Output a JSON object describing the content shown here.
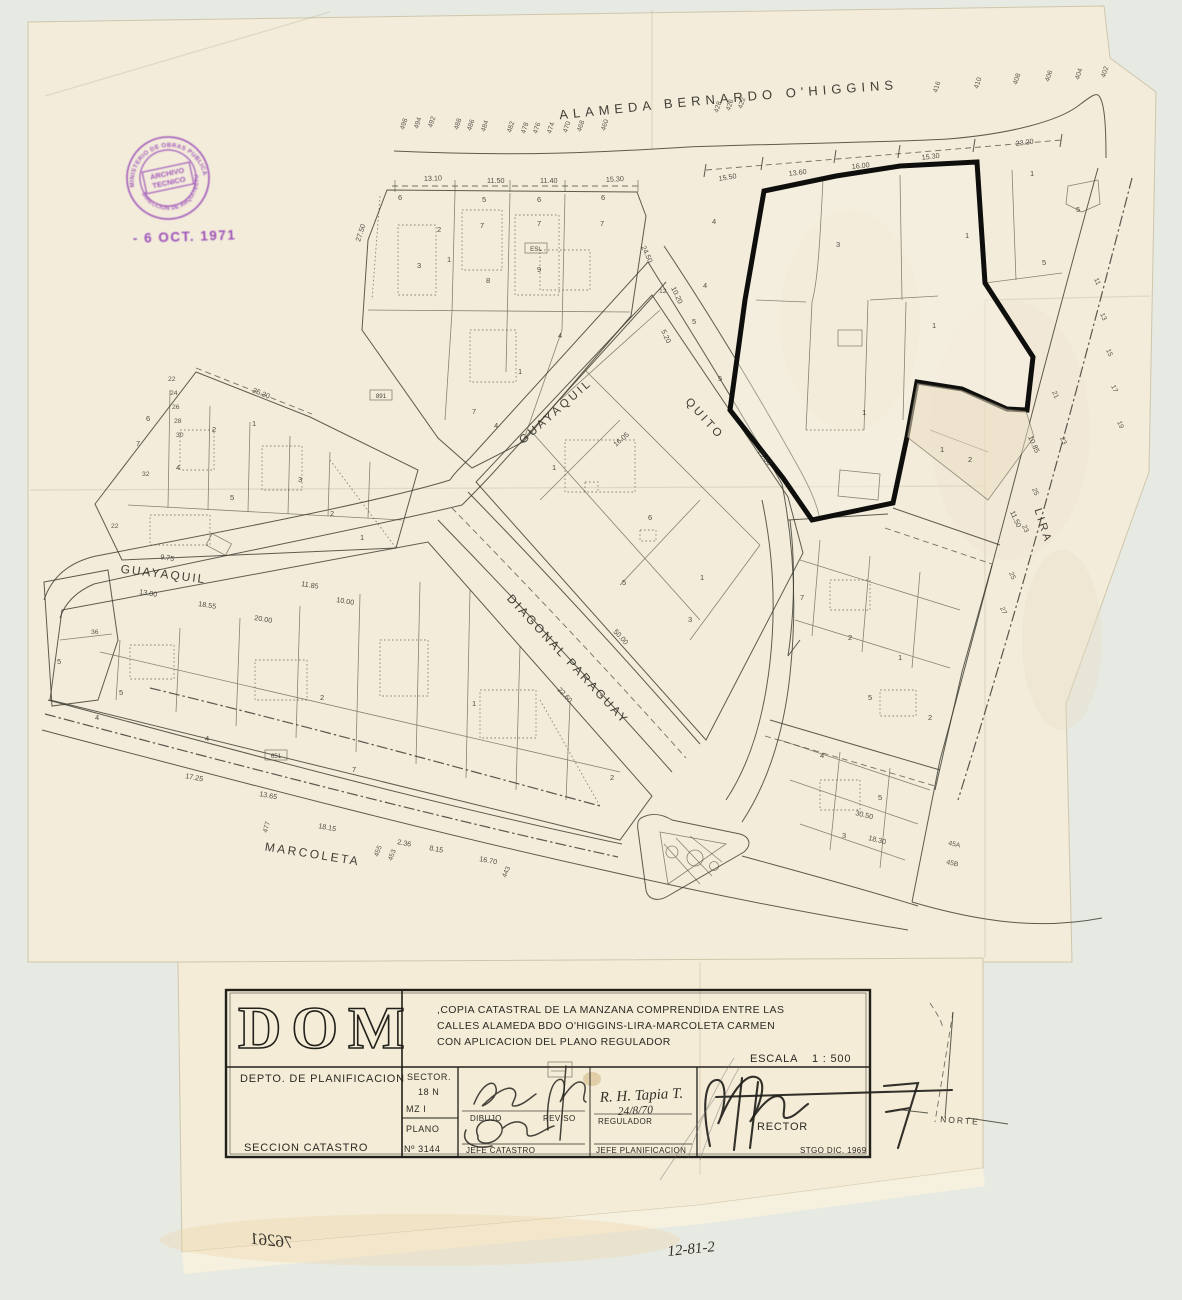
{
  "colors": {
    "paper": "#f3ecda",
    "paper_lower": "#f4ecd7",
    "background": "#e7eae2",
    "ink": "#3c3a30",
    "highlight_outline": "#0e0e0c",
    "stamp_purple": "#8d34b4",
    "pencil_blue": "#8a90ad"
  },
  "stamp": {
    "ring_top": "MINISTERIO DE OBRAS PUBLICAS Y TRANSPORTES",
    "ring_bottom": "DIRECCION DE ARQUITECTURA",
    "center_line1": "ARCHIVO",
    "center_line2": "TECNICO",
    "date_received": "- 6 OCT. 1971"
  },
  "map": {
    "alameda_label": "ALAMEDA  BERNARDO  O'HIGGINS",
    "street_labels": [
      {
        "text": "GUAYAQUIL",
        "x": 558,
        "y": 414,
        "rot": -41,
        "fs": 11.5,
        "ls": 3
      },
      {
        "text": "QUITO",
        "x": 702,
        "y": 421,
        "rot": 48,
        "fs": 11.5,
        "ls": 3
      },
      {
        "text": "GUAYAQUIL",
        "x": 163,
        "y": 578,
        "rot": 7,
        "fs": 12,
        "ls": 2
      },
      {
        "text": "DIAGONAL  PARAGUAY",
        "x": 565,
        "y": 662,
        "rot": 47,
        "fs": 12,
        "ls": 2.5
      },
      {
        "text": "MARCOLETA",
        "x": 312,
        "y": 858,
        "rot": 9,
        "fs": 12,
        "ls": 2.5
      },
      {
        "text": "LIRA",
        "x": 1040,
        "y": 527,
        "rot": 72,
        "fs": 11,
        "ls": 3
      }
    ],
    "alameda_numbers": [
      [
        "498",
        404,
        130
      ],
      [
        "494",
        418,
        129
      ],
      [
        "492",
        432,
        128
      ],
      [
        "488",
        458,
        130
      ],
      [
        "486",
        471,
        131
      ],
      [
        "484",
        485,
        132
      ],
      [
        "482",
        511,
        133
      ],
      [
        "478",
        525,
        134
      ],
      [
        "476",
        537,
        134
      ],
      [
        "474",
        551,
        134
      ],
      [
        "470",
        567,
        133
      ],
      [
        "468",
        581,
        132
      ],
      [
        "460",
        605,
        131
      ],
      [
        "428",
        718,
        113
      ],
      [
        "426",
        730,
        111
      ],
      [
        "422",
        742,
        109
      ],
      [
        "416",
        937,
        93
      ],
      [
        "410",
        978,
        89
      ],
      [
        "408",
        1017,
        85
      ],
      [
        "406",
        1049,
        82
      ],
      [
        "404",
        1079,
        80
      ],
      [
        "402",
        1105,
        78
      ]
    ],
    "dimensions": [
      [
        "13.10",
        424,
        181,
        -2
      ],
      [
        "11.50",
        487,
        183,
        0
      ],
      [
        "11.40",
        540,
        183,
        0
      ],
      [
        "15.30",
        606,
        182,
        -3
      ],
      [
        "15.50",
        719,
        181,
        -9
      ],
      [
        "13.60",
        789,
        176,
        -7
      ],
      [
        "16.00",
        852,
        169,
        -6
      ],
      [
        "15.30",
        922,
        160,
        -7
      ],
      [
        "23.20",
        1016,
        146,
        -8
      ],
      [
        "25.20",
        252,
        392,
        22
      ],
      [
        "27.50",
        360,
        242,
        -72
      ],
      [
        "24.50",
        641,
        247,
        65
      ],
      [
        "10.20",
        671,
        288,
        65
      ],
      [
        "5.20",
        661,
        331,
        65
      ],
      [
        "29.50",
        757,
        452,
        50
      ],
      [
        "16.05",
        616,
        447,
        -41
      ],
      [
        "9.75",
        160,
        559,
        9
      ],
      [
        "13.00",
        139,
        594,
        9
      ],
      [
        "18.55",
        198,
        606,
        9
      ],
      [
        "20.00",
        254,
        620,
        9
      ],
      [
        "11.85",
        301,
        586,
        9
      ],
      [
        "10.00",
        336,
        602,
        9
      ],
      [
        "17.25",
        185,
        778,
        11
      ],
      [
        "13.65",
        259,
        796,
        11
      ],
      [
        "18.15",
        318,
        828,
        11
      ],
      [
        "2.36",
        397,
        844,
        11
      ],
      [
        "8.15",
        429,
        850,
        11
      ],
      [
        "16.70",
        479,
        861,
        11
      ],
      [
        "50.00",
        613,
        632,
        47
      ],
      [
        "22.60",
        557,
        690,
        47
      ],
      [
        "10.85",
        1028,
        437,
        66
      ],
      [
        "11.50",
        1010,
        512,
        66
      ],
      [
        "30.50",
        855,
        815,
        14
      ],
      [
        "18.30",
        868,
        840,
        14
      ]
    ],
    "lot_numbers": [
      [
        "6",
        398,
        200
      ],
      [
        "5",
        482,
        202
      ],
      [
        "6",
        537,
        202
      ],
      [
        "6",
        601,
        200
      ],
      [
        "7",
        480,
        228
      ],
      [
        "2",
        437,
        232
      ],
      [
        "7",
        537,
        226
      ],
      [
        "7",
        600,
        226
      ],
      [
        "3",
        417,
        268
      ],
      [
        "1",
        447,
        262
      ],
      [
        "8",
        486,
        283
      ],
      [
        "9",
        537,
        272
      ],
      [
        "4",
        558,
        338
      ],
      [
        "1",
        518,
        374
      ],
      [
        "7",
        472,
        414
      ],
      [
        "4",
        494,
        428
      ],
      [
        "4",
        712,
        224
      ],
      [
        "4",
        703,
        288
      ],
      [
        "5",
        692,
        324
      ],
      [
        "5",
        718,
        381
      ],
      [
        "3",
        836,
        247
      ],
      [
        "1",
        965,
        238
      ],
      [
        "1",
        932,
        328
      ],
      [
        "1",
        862,
        415
      ],
      [
        "1",
        940,
        452
      ],
      [
        "2",
        968,
        462
      ],
      [
        "5",
        1042,
        265
      ],
      [
        "1",
        1030,
        176
      ],
      [
        "5",
        1076,
        212
      ],
      [
        "2",
        212,
        432
      ],
      [
        "1",
        252,
        426
      ],
      [
        "7",
        136,
        446
      ],
      [
        "4",
        176,
        470
      ],
      [
        "6",
        146,
        421
      ],
      [
        "5",
        230,
        500
      ],
      [
        "3",
        298,
        482
      ],
      [
        "2",
        330,
        516
      ],
      [
        "1",
        360,
        540
      ],
      [
        "5",
        119,
        695
      ],
      [
        "4",
        205,
        741
      ],
      [
        "2",
        320,
        700
      ],
      [
        "1",
        472,
        706
      ],
      [
        "7",
        352,
        772
      ],
      [
        "2",
        610,
        780
      ],
      [
        "1",
        552,
        470
      ],
      [
        "6",
        648,
        520
      ],
      [
        "5",
        622,
        585
      ],
      [
        "1",
        700,
        580
      ],
      [
        "3",
        688,
        622
      ],
      [
        "7",
        800,
        600
      ],
      [
        "2",
        848,
        640
      ],
      [
        "1",
        898,
        660
      ],
      [
        "5",
        868,
        700
      ],
      [
        "2",
        928,
        720
      ],
      [
        "4",
        820,
        758
      ],
      [
        "5",
        878,
        800
      ],
      [
        "3",
        842,
        838
      ],
      [
        "5",
        57,
        664
      ],
      [
        "4",
        95,
        720
      ]
    ],
    "addresses": [
      [
        "477",
        267,
        833,
        -75
      ],
      [
        "455",
        378,
        857,
        -70
      ],
      [
        "453",
        392,
        861,
        -70
      ],
      [
        "443",
        506,
        878,
        -68
      ],
      [
        "45A",
        948,
        845,
        12
      ],
      [
        "45B",
        946,
        864,
        12
      ],
      [
        "12",
        659,
        293,
        0
      ],
      [
        "11",
        1094,
        279,
        66
      ],
      [
        "13",
        1100,
        314,
        66
      ],
      [
        "15",
        1106,
        350,
        66
      ],
      [
        "17",
        1111,
        386,
        66
      ],
      [
        "19",
        1117,
        422,
        66
      ],
      [
        "21",
        1052,
        392,
        66
      ],
      [
        "23",
        1060,
        438,
        66
      ],
      [
        "25",
        1032,
        489,
        66
      ],
      [
        "23",
        1022,
        526,
        66
      ],
      [
        "25",
        1009,
        573,
        66
      ],
      [
        "27",
        1000,
        608,
        66
      ],
      [
        "22",
        168,
        381,
        0
      ],
      [
        "24",
        170,
        395,
        0
      ],
      [
        "26",
        172,
        409,
        0
      ],
      [
        "28",
        174,
        423,
        0
      ],
      [
        "30",
        176,
        437,
        0
      ],
      [
        "32",
        142,
        476,
        0
      ],
      [
        "22",
        111,
        528,
        0
      ],
      [
        "36",
        91,
        634,
        0
      ]
    ],
    "small_boxes": [
      [
        "ESL",
        536,
        250
      ],
      [
        "891",
        381,
        397
      ],
      [
        "651",
        276,
        757
      ]
    ]
  },
  "title_block": {
    "dom": "DOM",
    "description_line1": ",COPIA  CATASTRAL  DE LA  MANZANA  COMPRENDIDA   ENTRE  LAS",
    "description_line2": "CALLES  ALAMEDA  BDO  O'HIGGINS-LIRA-MARCOLETA   CARMEN",
    "description_line3": "CON  APLICACION  DEL  PLANO  REGULADOR",
    "escala_label": "ESCALA",
    "escala_value": "1 : 500",
    "depto": "DEPTO. DE PLANIFICACION",
    "seccion": "SECCION   CATASTRO",
    "sector_label": "SECTOR.",
    "sector_value": "18 N",
    "mz": "MZ  I",
    "plano_label": "PLANO",
    "plano_value": "Nº 3144",
    "dibujo": "DIBUJO",
    "reviso": "REVISO",
    "regulador": "REGULADOR",
    "regulador_name": "R. H. Tapia T.",
    "regulador_date": "24/8/70",
    "jefe_catastro": "JEFE  CATASTRO",
    "jefe_planificacion": "JEFE  PLANIFICACION",
    "director": "RECTOR",
    "place_date": "STGO   DIC.  1969"
  },
  "north_arrow": {
    "label": "NORTE"
  },
  "handwritten": {
    "mirrored_number": "76261",
    "catalog_number": "12-81-2"
  }
}
